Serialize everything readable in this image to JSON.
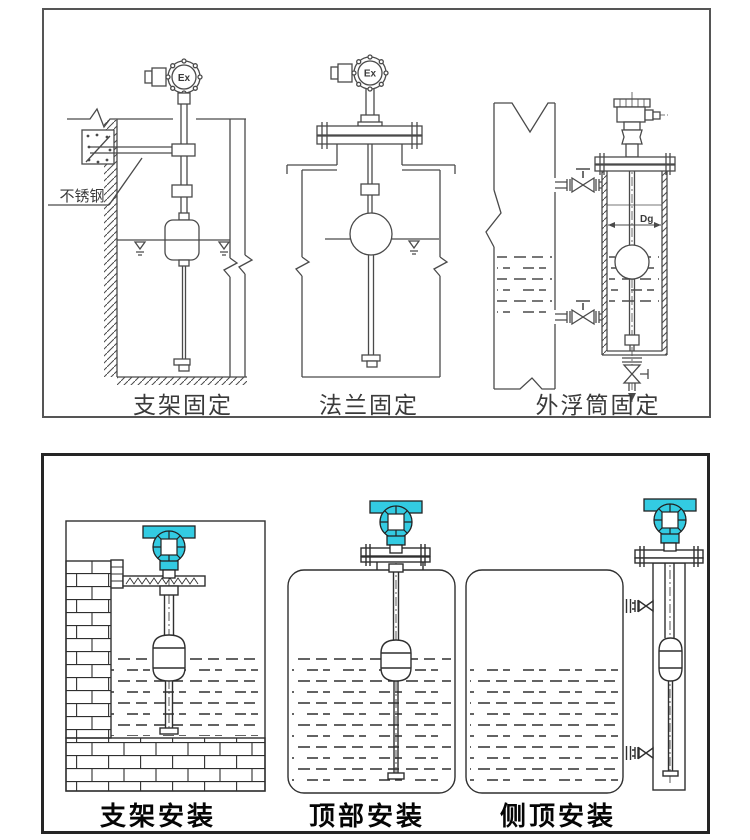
{
  "page": {
    "background": "#ffffff",
    "line_color_top": "#4a4a4a",
    "line_color_bottom": "#2f2f2f",
    "accent_cyan": "#33cbe2"
  },
  "top_panel": {
    "diagrams": [
      {
        "caption": "支架固定",
        "head_label": "Ex",
        "annotation": "不锈钢"
      },
      {
        "caption": "法兰固定",
        "head_label": "Ex"
      },
      {
        "caption": "外浮筒固定",
        "dimension_label": "Dg"
      }
    ]
  },
  "bottom_panel": {
    "diagrams": [
      {
        "caption": "支架安装"
      },
      {
        "caption": "顶部安装"
      },
      {
        "caption": "侧顶安装"
      }
    ]
  }
}
